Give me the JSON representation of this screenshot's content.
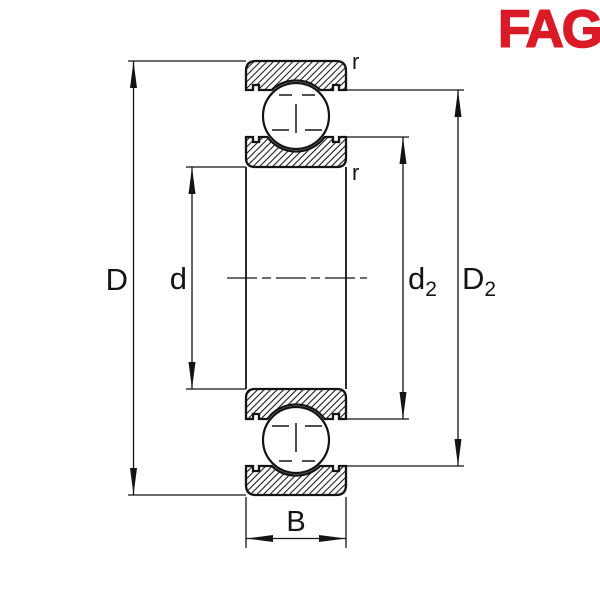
{
  "logo": {
    "text": "FAG",
    "color": "#DA1A26"
  },
  "drawing": {
    "description": "deep groove ball bearing cross-section, axial section view",
    "line_color": "#141414",
    "background_color": "#ffffff",
    "labels": {
      "outer_diameter": "D",
      "bore_diameter": "d",
      "inner_shoulder_base": "d",
      "inner_shoulder_sub": "2",
      "outer_shoulder_base": "D",
      "outer_shoulder_sub": "2",
      "width": "B",
      "radius_top": "r",
      "radius_inner": "r"
    }
  }
}
